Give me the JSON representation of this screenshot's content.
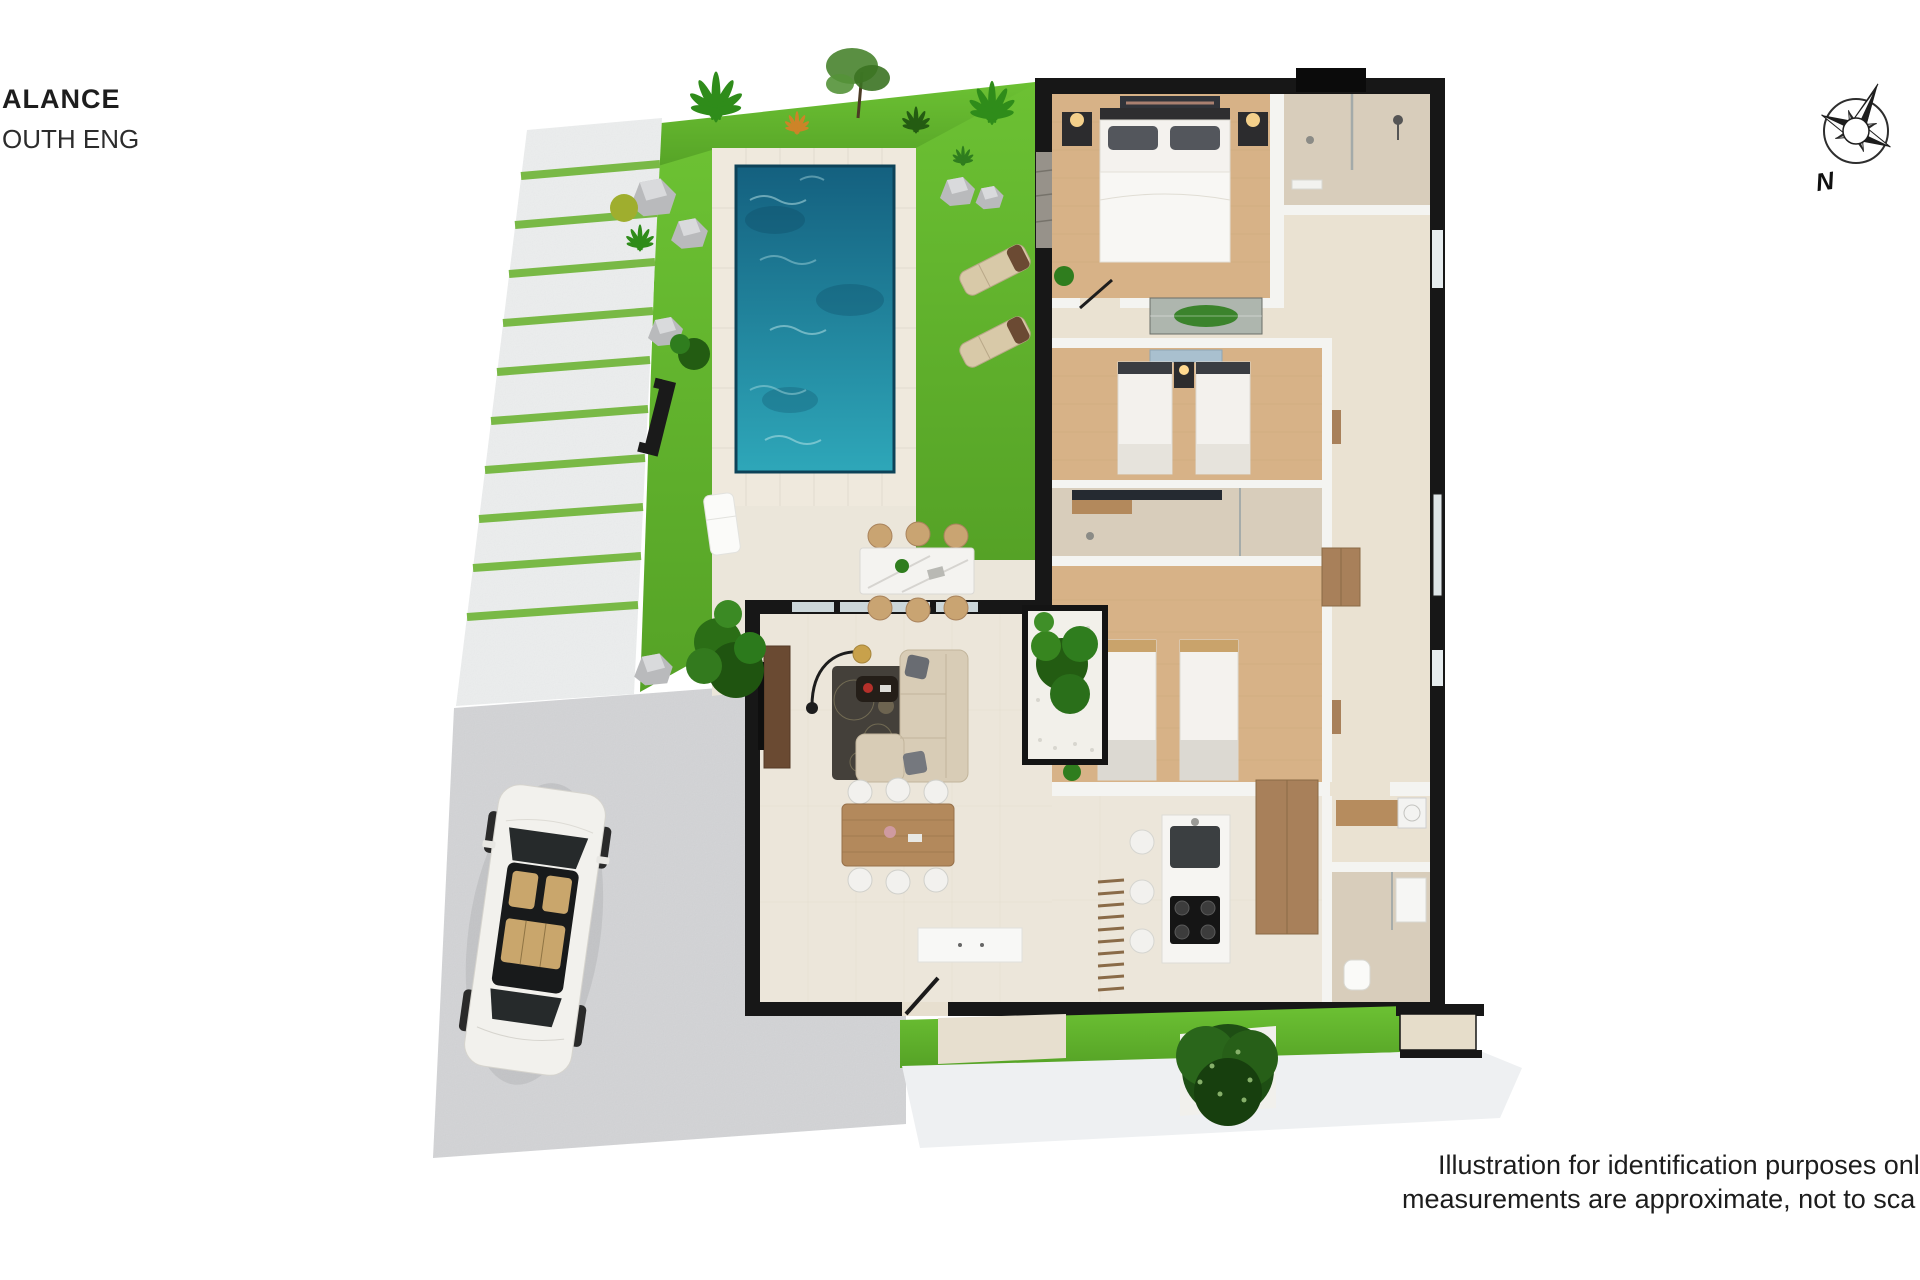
{
  "branding": {
    "line1": "ALANCE",
    "line2": "OUTH ENG"
  },
  "compass": {
    "label": "N",
    "icon": "compass-rose-icon"
  },
  "disclaimer": {
    "line1": "Illustration for identification purposes onl",
    "line2": "measurements are approximate, not to sca"
  },
  "colors": {
    "text": "#1d1d1d",
    "wall": "#171717",
    "interior_wall": "#f4f4f1",
    "grass": "#6cc133",
    "grass_dark": "#55a226",
    "stripe_green": "#79b946",
    "pool_water": "#2ea7b9",
    "pool_water_deep": "#14607f",
    "pool_deck": "#efe9dd",
    "tile_line": "#d9d2c2",
    "patio": "#ebe6da",
    "driveway": "#d7d8da",
    "pavement": "#eef0f2",
    "parking_strip": "#eff1f1",
    "wood_floor": "#d7b287",
    "tile_floor": "#eae2d2",
    "bath_tile": "#d8cdbb",
    "living_floor": "#ece6da",
    "wood_furniture": "#b3895c",
    "cabinet_wood": "#a8805a",
    "marble": "#f4f3f0",
    "island": "#f6f5f2",
    "sofa": "#d8ccb6",
    "rug": "#44403a",
    "car_body": "#f2f1ed",
    "glass": "#ccd7da",
    "plant": "#2f7d1e",
    "plant_dark": "#235c12",
    "rock": "#b9babc",
    "lounger": "#d8c9a8",
    "lamp_gold": "#c8a14b"
  }
}
